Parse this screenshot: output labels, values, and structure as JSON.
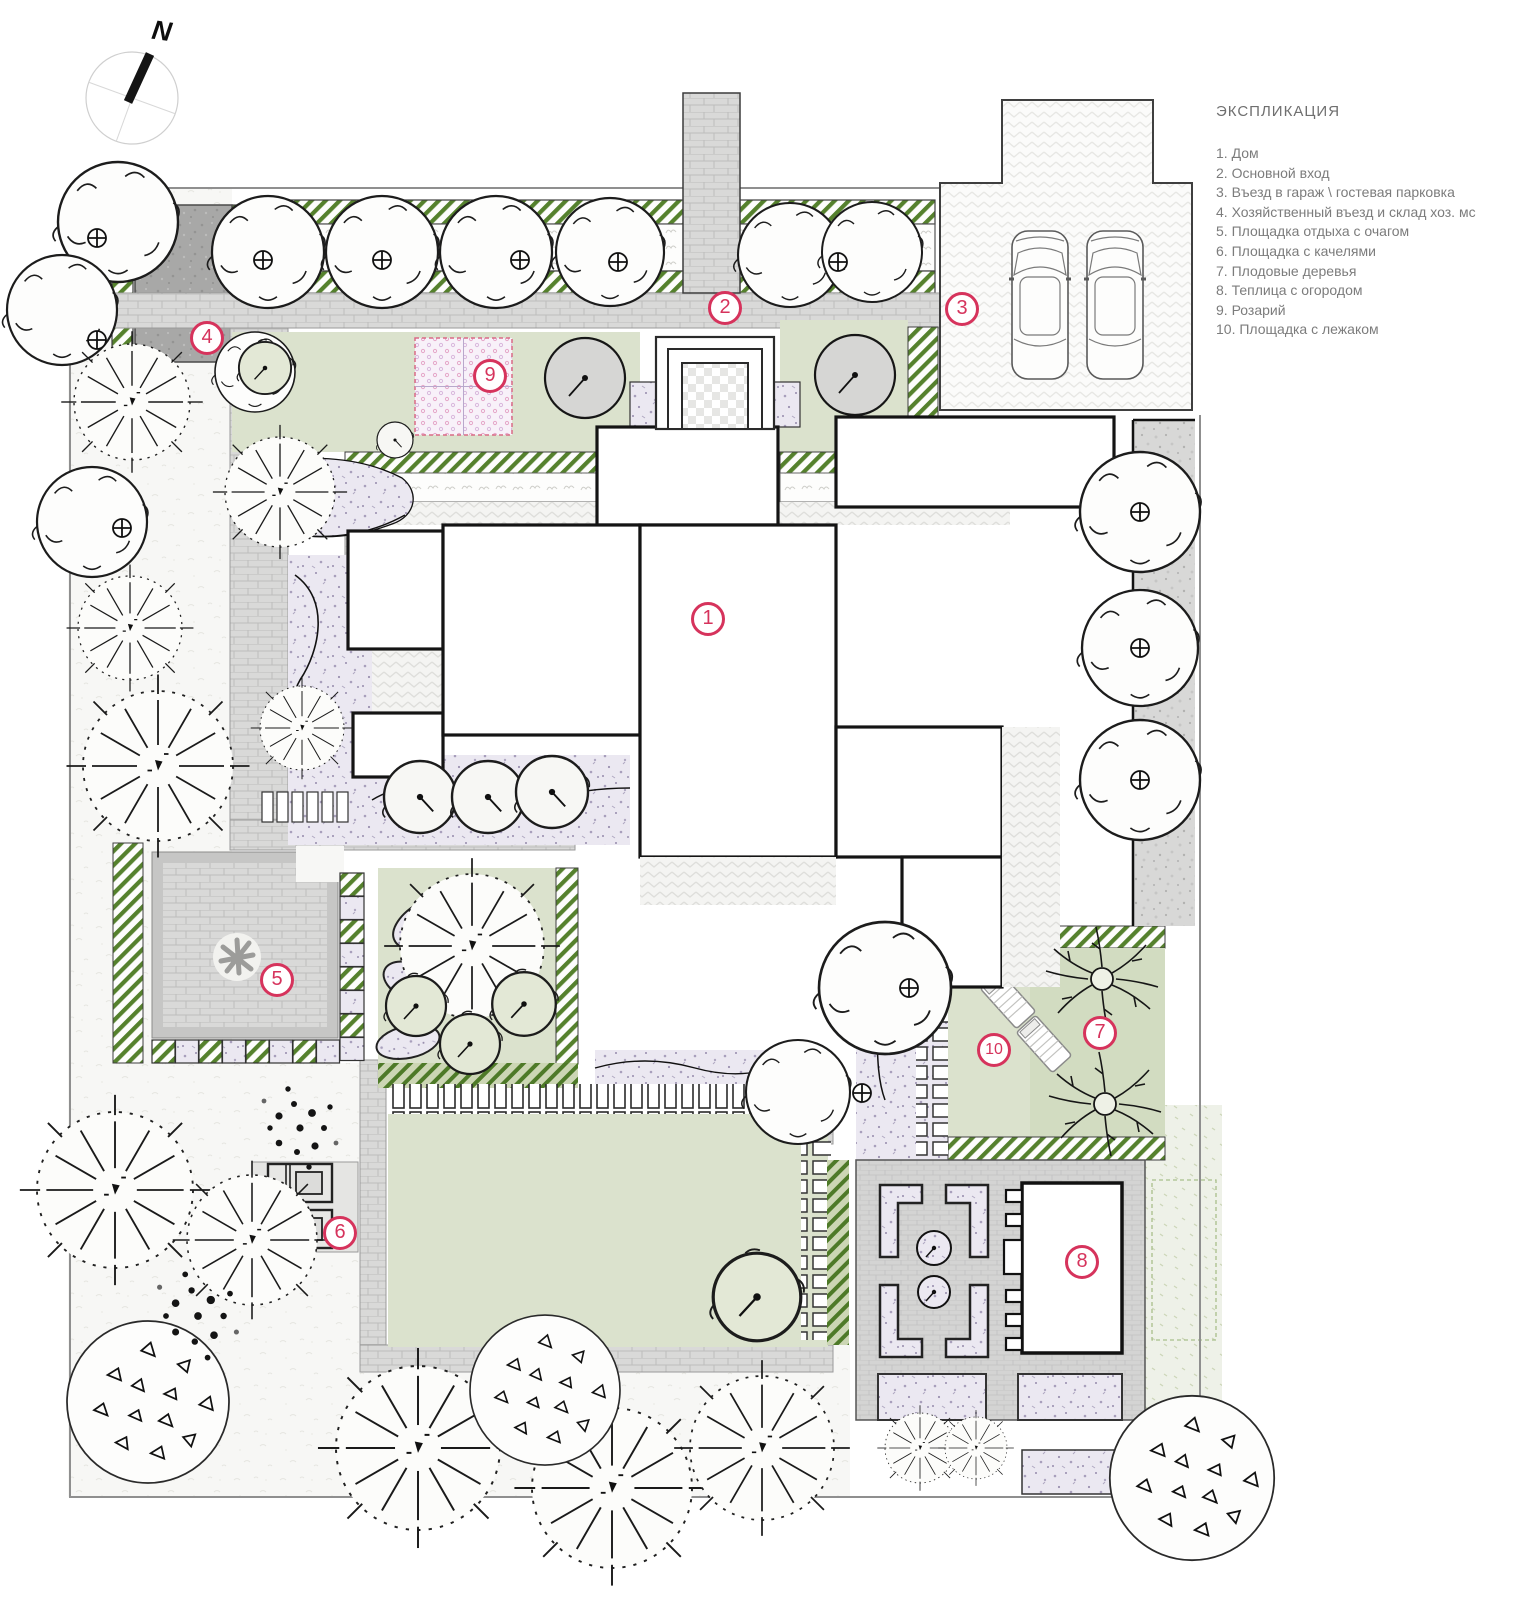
{
  "compass": {
    "north_label": "N"
  },
  "legend": {
    "title": "ЭКСПЛИКАЦИЯ",
    "items": [
      "1. Дом",
      "2. Основной вход",
      "3. Въезд в гараж \\ гостевая парковка",
      "4. Хозяйственный въезд и склад хоз. мс",
      "5. Площадка отдыха с очагом",
      "6. Площадка с качелями",
      "7. Плодовые деревья",
      "8. Теплица с огородом",
      "9. Розарий",
      "10. Площадка с лежаком"
    ]
  },
  "markers": [
    {
      "label": "1"
    },
    {
      "label": "2"
    },
    {
      "label": "3"
    },
    {
      "label": "4"
    },
    {
      "label": "5"
    },
    {
      "label": "6"
    },
    {
      "label": "7"
    },
    {
      "label": "8"
    },
    {
      "label": "9"
    },
    {
      "label": "10"
    }
  ],
  "colors": {
    "marker_accent": "#d6335c",
    "hatch_green": "#55812d",
    "lawn_green": "#dbe2cd",
    "bed_lavender": "#ebe8f1",
    "paving_gray": "#d9d9d8",
    "rose_garden_pink": "#e5a8c9"
  }
}
